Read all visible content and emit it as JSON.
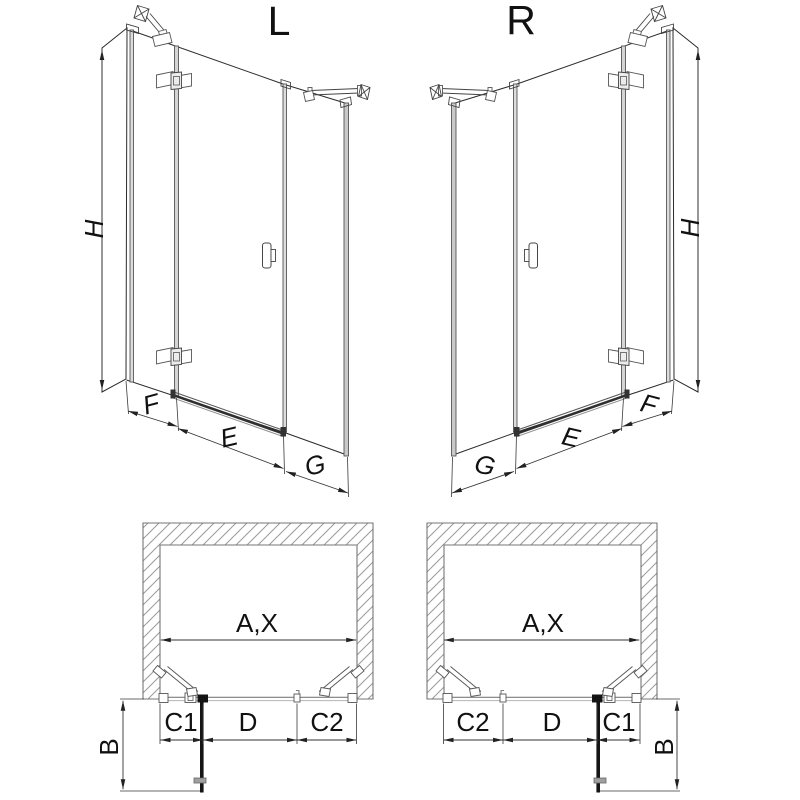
{
  "drawing": {
    "elevation_left": {
      "view_label": "L",
      "height_label": "H",
      "segment_f_label": "F",
      "segment_e_label": "E",
      "segment_g_label": "G"
    },
    "elevation_right": {
      "view_label": "R",
      "height_label": "H",
      "segment_f_label": "F",
      "segment_e_label": "E",
      "segment_g_label": "G"
    },
    "plan_left": {
      "width_label": "A,X",
      "c1_label": "C1",
      "d_label": "D",
      "c2_label": "C2",
      "depth_label": "B"
    },
    "plan_right": {
      "width_label": "A,X",
      "c1_label": "C1",
      "d_label": "D",
      "c2_label": "C2",
      "depth_label": "B"
    }
  },
  "colors": {
    "background": "#ffffff",
    "line": "#2b2b2b",
    "dimension_line": "#333333",
    "glass_profile_fill": "#dcdcdc",
    "wall_outline": "#767676",
    "wall_hatch": "#9a9a9a",
    "open_door_panel": "#141414"
  }
}
